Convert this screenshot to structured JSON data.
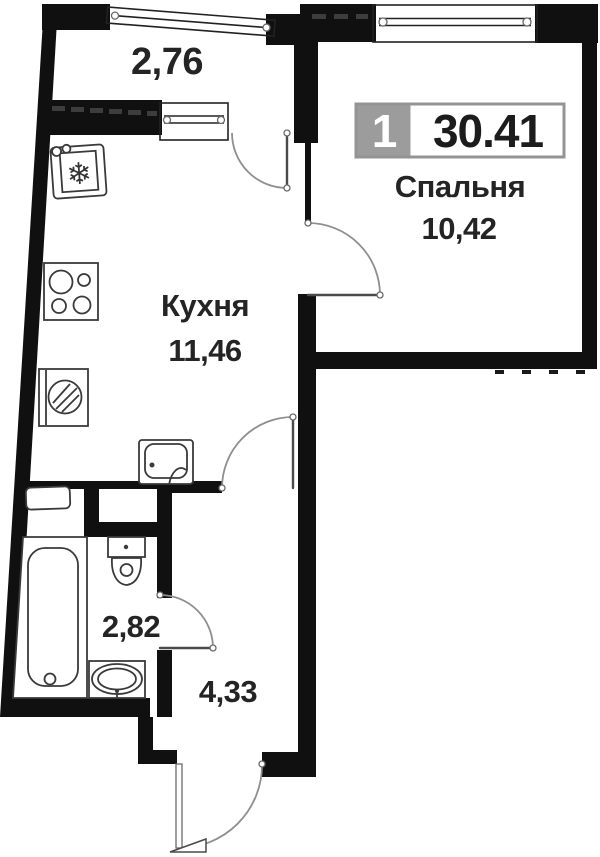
{
  "floor_plan": {
    "badge": {
      "room_count": "1",
      "total_area": "30.41"
    },
    "labels": {
      "balcony_area": "2,76",
      "kitchen_name": "Кухня",
      "kitchen_area": "11,46",
      "bedroom_name": "Спальня",
      "bedroom_area": "10,42",
      "bathroom_area": "2,82",
      "hall_area": "4,33"
    },
    "icons": {
      "snowflake": "❄"
    },
    "colors": {
      "wall": "#101010",
      "badge_gray": "#9c9c9c",
      "badge_border": "#949494",
      "text": "#242424",
      "door_arc": "#8f8f8f",
      "background": "#ffffff"
    }
  }
}
